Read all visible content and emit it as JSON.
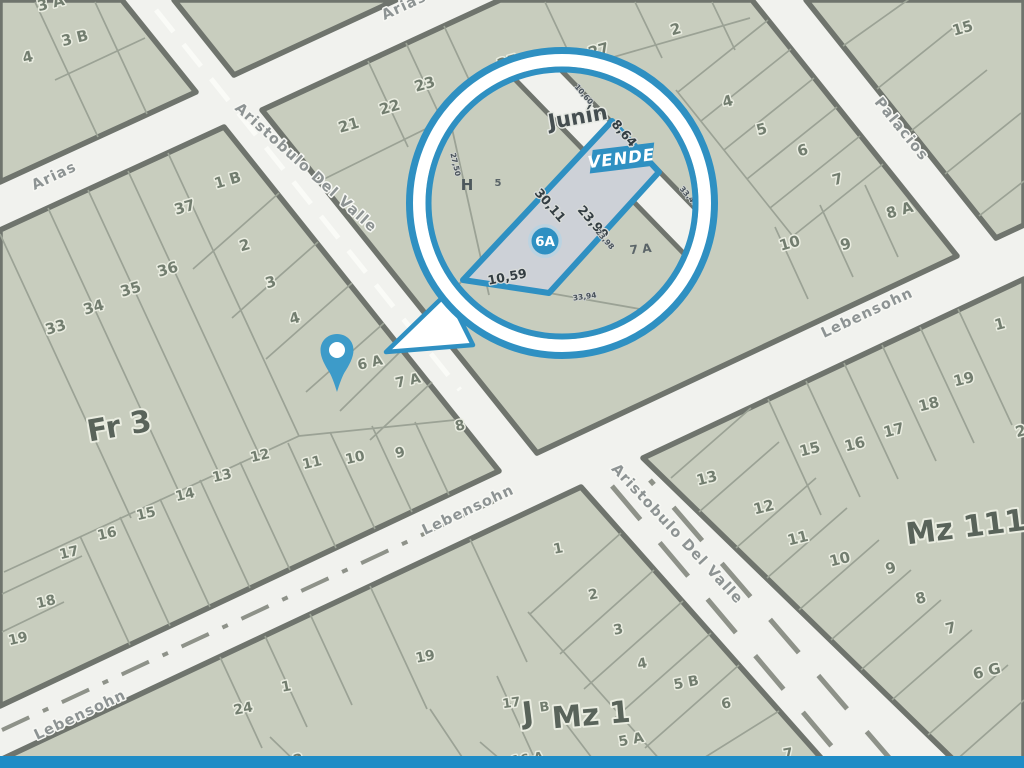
{
  "streets": [
    {
      "id": "arias-left",
      "name": "Arias"
    },
    {
      "id": "arias-top",
      "name": "Arias"
    },
    {
      "id": "aristobulo-upper",
      "name": "Aristobulo Del Valle"
    },
    {
      "id": "aristobulo-lower",
      "name": "Aristobulo Del Valle"
    },
    {
      "id": "lebensohn-left",
      "name": "Lebensohn"
    },
    {
      "id": "lebensohn-mid",
      "name": "Lebensohn"
    },
    {
      "id": "lebensohn-right",
      "name": "Lebensohn"
    },
    {
      "id": "palacios",
      "name": "Palacios"
    }
  ],
  "areas": [
    {
      "name": "Fr 3"
    },
    {
      "name": "Mz 111"
    },
    {
      "name": "Mz 1"
    },
    {
      "name": "J"
    }
  ],
  "lots": [
    "3 A",
    "3 B",
    "4",
    "21",
    "22",
    "23",
    "25",
    "27",
    "2",
    "4",
    "5",
    "6",
    "7",
    "8 A",
    "9",
    "10",
    "15",
    "1 B",
    "37",
    "2",
    "36",
    "35",
    "3",
    "34",
    "33",
    "4",
    "6 A",
    "7 A",
    "8",
    "9",
    "10",
    "11",
    "12",
    "13",
    "14",
    "15",
    "16",
    "17",
    "18",
    "19",
    "1",
    "19",
    "18",
    "17",
    "16",
    "15",
    "13",
    "12",
    "11",
    "10",
    "9",
    "8",
    "7",
    "6 G",
    "2",
    "19",
    "1",
    "2",
    "3",
    "4",
    "5 B",
    "6",
    "5 A",
    "7",
    "24",
    "1",
    "17",
    "B",
    "16 A",
    "2"
  ],
  "magnifier": {
    "street_name": "Junín",
    "banner": "VENDE",
    "lot_id": "6A",
    "dimensions": {
      "top": "8,64",
      "left": "30,11",
      "right": "23,99",
      "bottom": "10,59"
    },
    "survey_numbers": [
      "27,50",
      "10,60",
      "33,47",
      "23,98",
      "33,94"
    ],
    "neighbor_labels": [
      "H",
      "5",
      "7 A"
    ]
  },
  "colors": {
    "accent_blue": "#2f90c2",
    "pin_blue": "#3d9bc9",
    "bar_blue": "#1f8cc6",
    "block_fill": "#c8cdbe",
    "street_fill": "#f1f2ee",
    "highlight_lot_fill": "#cdd1d7"
  }
}
